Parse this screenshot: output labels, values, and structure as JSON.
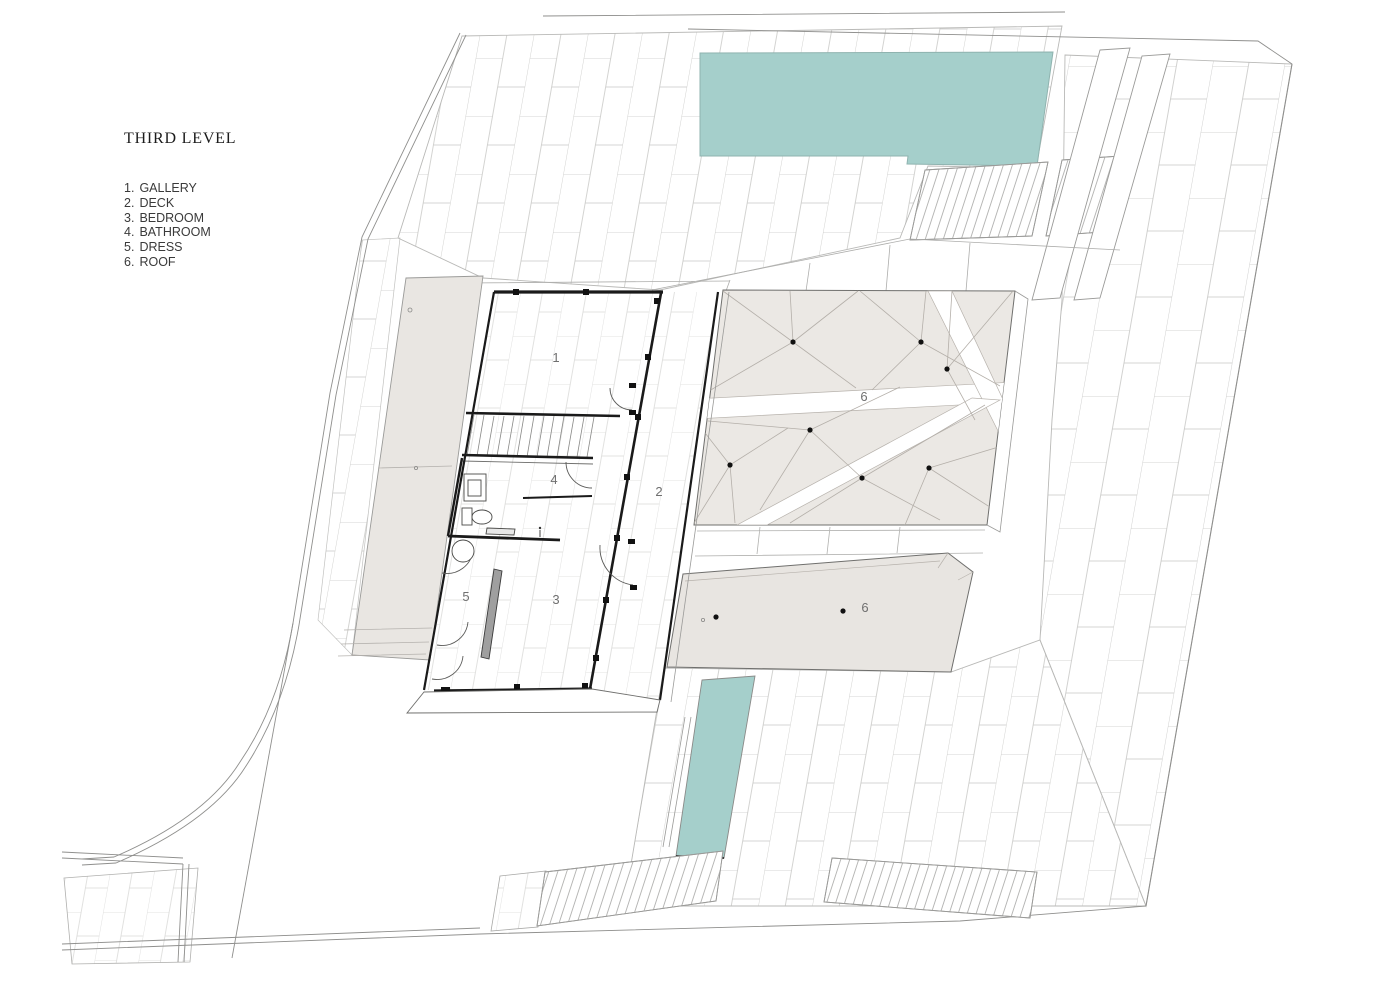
{
  "meta": {
    "drawing_type": "architectural floor plan",
    "sheet": "site / third floor plan"
  },
  "title_block": {
    "title": "THIRD LEVEL"
  },
  "legend": {
    "items": [
      {
        "num": "1.",
        "label": "GALLERY"
      },
      {
        "num": "2.",
        "label": "DECK"
      },
      {
        "num": "3.",
        "label": "BEDROOM"
      },
      {
        "num": "4.",
        "label": "BATHROOM"
      },
      {
        "num": "5.",
        "label": "DRESS"
      },
      {
        "num": "6.",
        "label": "ROOF"
      }
    ]
  },
  "plan": {
    "room_labels": {
      "gallery": "1",
      "deck": "2",
      "bedroom": "3",
      "bathroom": "4",
      "dress": "5",
      "roof_main": "6",
      "roof_secondary": "6"
    }
  },
  "colors": {
    "pool_water": "#a5cfcb",
    "roof_fill": "#ebe8e4",
    "roof_secondary_fill": "#e8e5e1",
    "planter_fill": "#e9e6e2",
    "wall_black": "#1a1a1a",
    "tile_line": "#c6c6c4",
    "outline_gray": "#9a9a98",
    "label_gray": "#6f6f6f"
  }
}
